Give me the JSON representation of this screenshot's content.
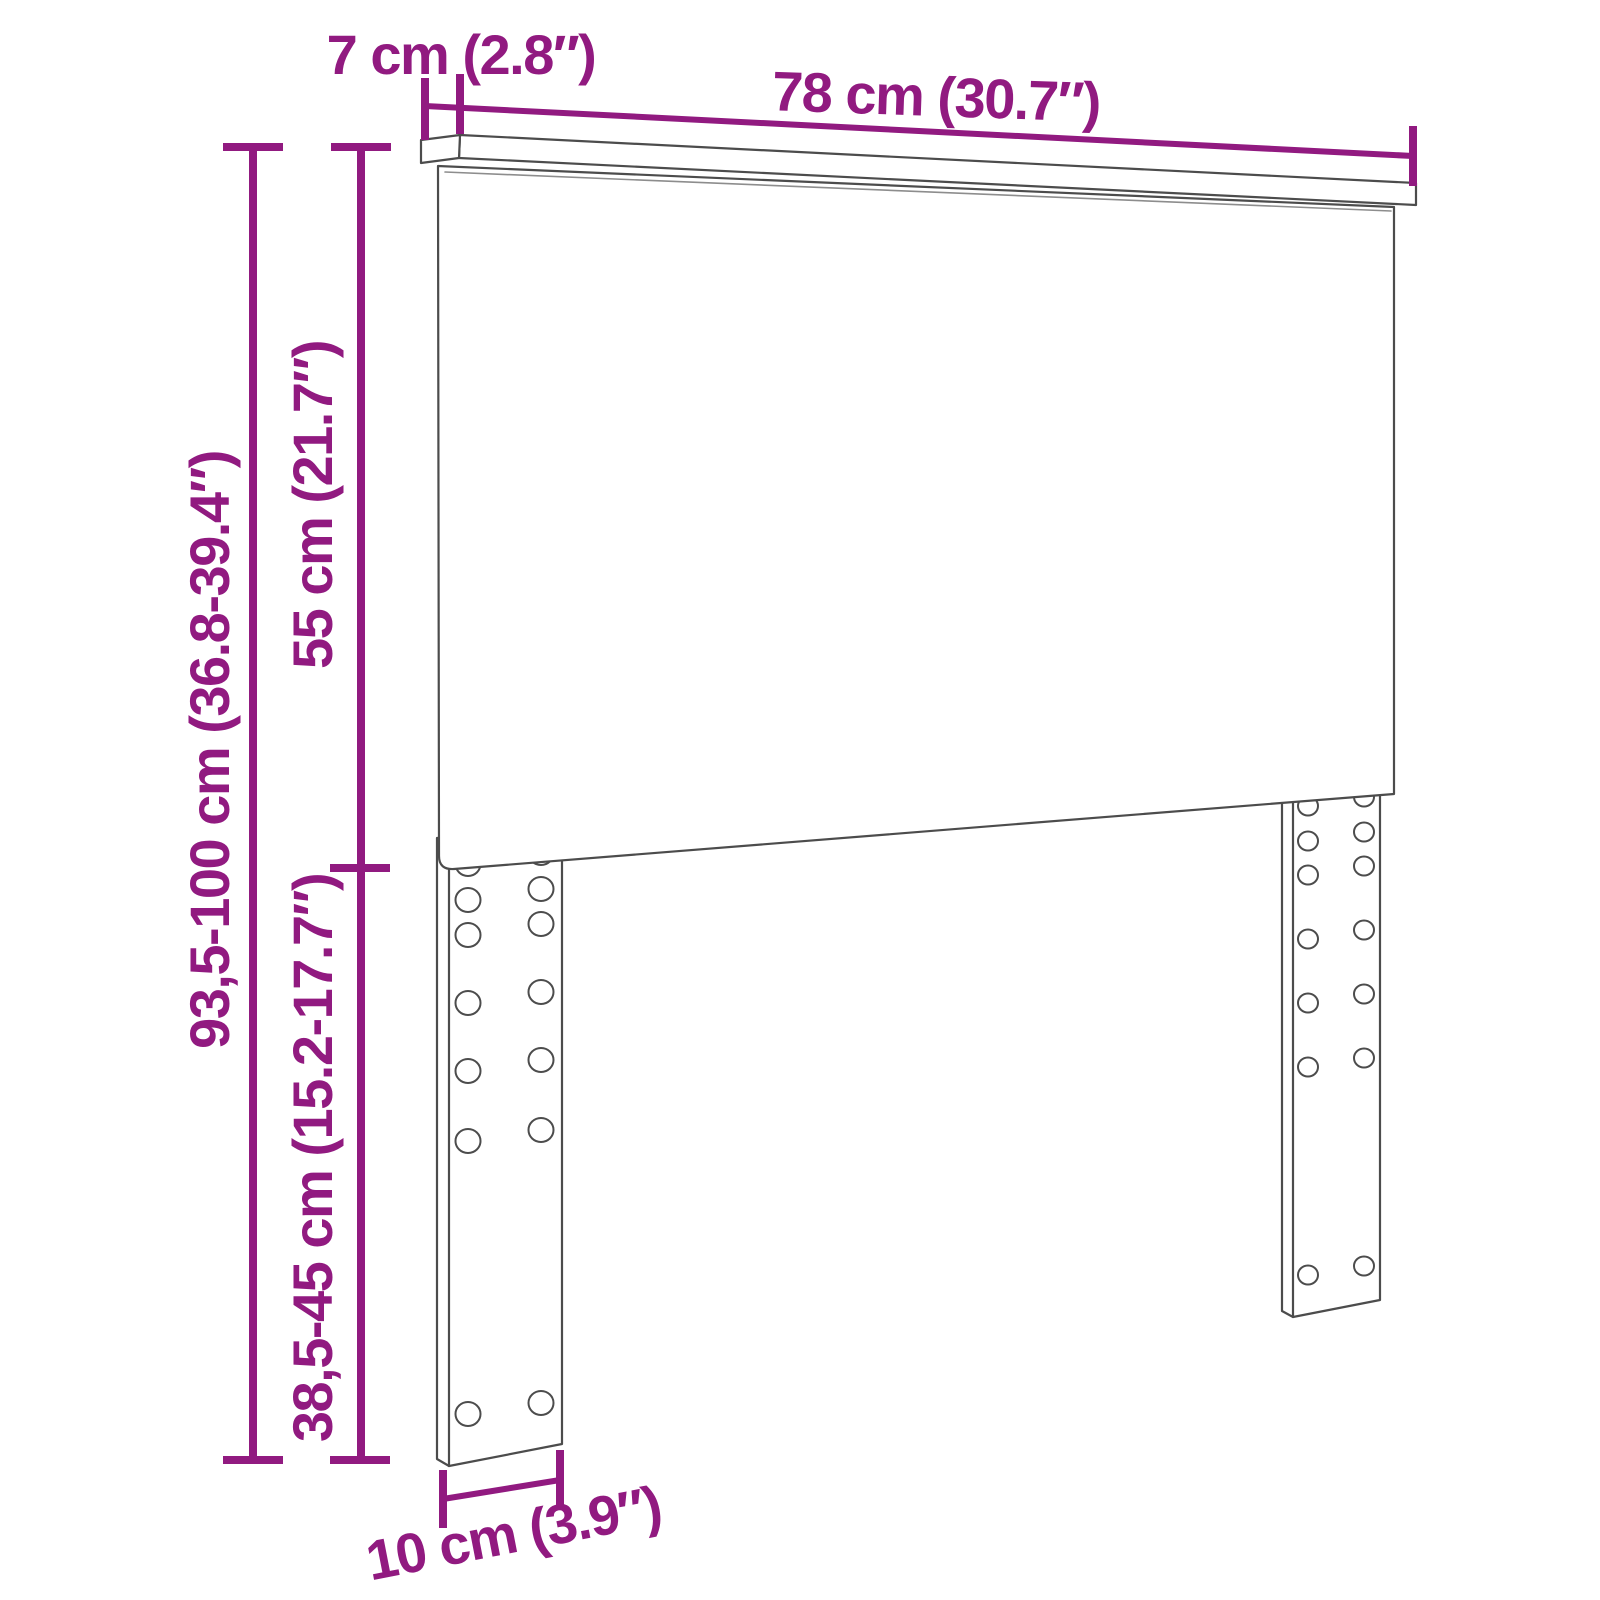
{
  "diagram": {
    "product": "headboard-with-mounting-legs",
    "view": "dimension-drawing",
    "colors": {
      "accent": "#911a80",
      "outline": "#4c4c4c",
      "background": "#ffffff"
    },
    "measurements": {
      "top_depth": "7 cm (2.8″)",
      "width": "78 cm (30.7″)",
      "panel_height": "55 cm (21.7″)",
      "total_height": "93,5-100 cm (36.8-39.4″)",
      "leg_height": "38,5-45 cm (15.2-17.7″)",
      "leg_depth": "10 cm (3.9″)"
    }
  }
}
